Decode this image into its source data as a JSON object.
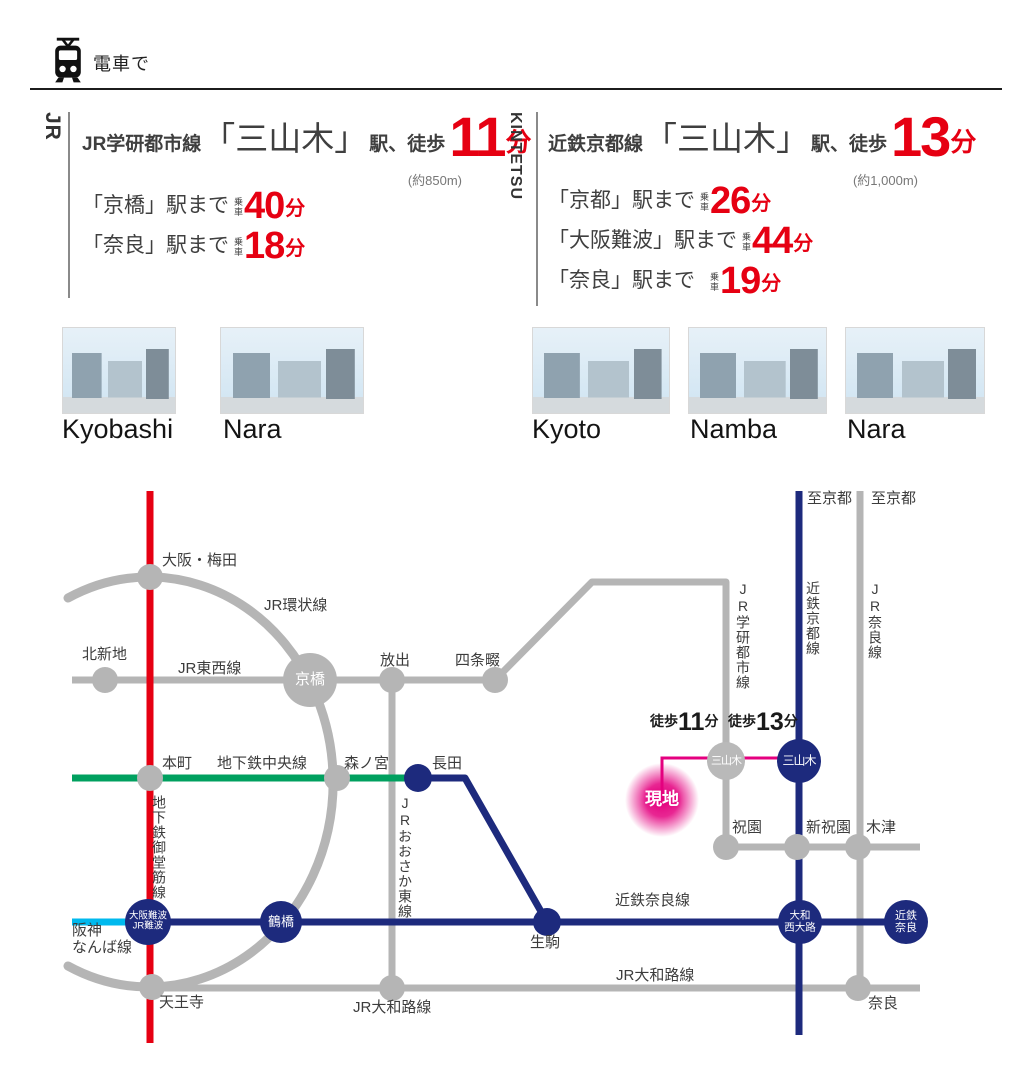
{
  "banner": {
    "title": "電車で"
  },
  "palette": {
    "jr_red": "#e60012",
    "navy": "#1d2a7d",
    "green": "#00a05f",
    "cyan": "#00b9ee",
    "pink": "#e4007f",
    "line_gray": "#b5b5b5"
  },
  "jr": {
    "tag": "JR",
    "line_name": "JR学研都市線",
    "station": "「三山木」",
    "suffix": "駅、徒歩",
    "walk_min": "11",
    "unit": "分",
    "distance": "(約850m)",
    "routes": [
      {
        "dest": "「京橋」駅まで",
        "ride": "乗車",
        "min": "40",
        "unit": "分"
      },
      {
        "dest": "「奈良」駅まで",
        "ride": "乗車",
        "min": "18",
        "unit": "分"
      }
    ],
    "photos": [
      {
        "label": "Kyobashi"
      },
      {
        "label": "Nara"
      }
    ]
  },
  "kintetsu": {
    "tag": "KINTETSU",
    "line_name": "近鉄京都線",
    "station": "「三山木」",
    "suffix": "駅、徒歩",
    "walk_min": "13",
    "unit": "分",
    "distance": "(約1,000m)",
    "routes": [
      {
        "dest": "「京都」駅まで",
        "ride": "乗車",
        "min": "26",
        "unit": "分"
      },
      {
        "dest": "「大阪難波」駅まで",
        "ride": "乗車",
        "min": "44",
        "unit": "分"
      },
      {
        "dest": "「奈良」駅まで",
        "ride": "乗車",
        "min": "19",
        "unit": "分"
      }
    ],
    "photos": [
      {
        "label": "Kyoto"
      },
      {
        "label": "Namba"
      },
      {
        "label": "Nara"
      }
    ]
  },
  "map": {
    "labels": {
      "osaka_umeda": "大阪・梅田",
      "jr_loop_line": "JR環状線",
      "kitashinchi": "北新地",
      "jr_tozai_line": "JR東西線",
      "kyobashi": "京橋",
      "hanaten": "放出",
      "shijonawate": "四条畷",
      "hommachi": "本町",
      "subway_chuo_line": "地下鉄中央線",
      "morinomiya": "森ノ宮",
      "nagata": "長田",
      "subway_midosuji_line": "地下鉄御堂筋線",
      "jr_osaka_higashi_line": "JRおおさか東線",
      "jr_gakkentoshi_line": "JR学研都市線",
      "kintetsu_kyoto_line": "近鉄京都線",
      "jr_nara_line": "JR奈良線",
      "to_kyoto": "至京都",
      "walk_label": "徒歩",
      "walk_jr_min": "11",
      "walk_kintetsu_min": "13",
      "min_unit": "分",
      "site": "現地",
      "miyamaki": "三山木",
      "hosono": "祝園",
      "shin_hosono": "新祝園",
      "kizu": "木津",
      "osaka_namba_l1": "大阪難波",
      "osaka_namba_l2": "JR難波",
      "hanshin_l1": "阪神",
      "hanshin_l2": "なんば線",
      "tsuruhashi": "鶴橋",
      "ikoma": "生駒",
      "kintetsu_nara_line": "近鉄奈良線",
      "saidaiji_l1": "大和",
      "saidaiji_l2": "西大路",
      "kintetsu_nara_l1": "近鉄",
      "kintetsu_nara_l2": "奈良",
      "jr_yamatoji_line": "JR大和路線",
      "tennoji": "天王寺",
      "nara": "奈良"
    }
  }
}
